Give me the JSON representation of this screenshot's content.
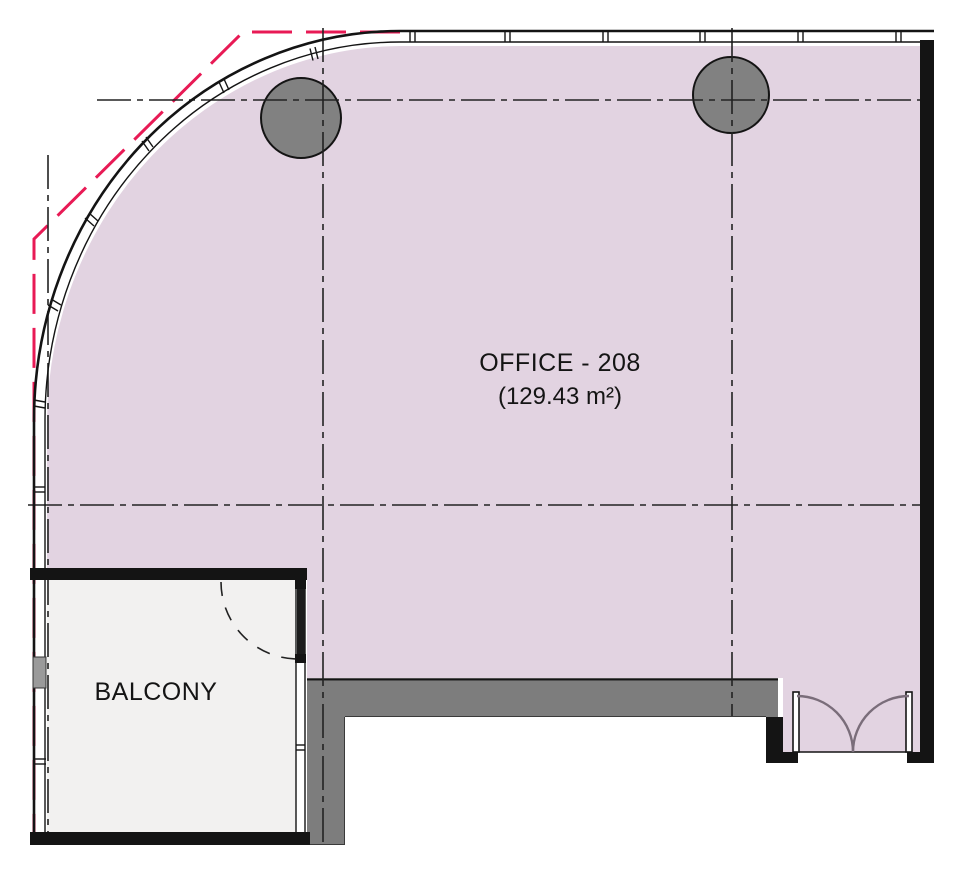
{
  "drawing": {
    "title": "Office 208 floor plan",
    "office": {
      "name": "OFFICE - 208",
      "area": "(129.43 m²)"
    },
    "balcony": {
      "name": "BALCONY"
    },
    "colors": {
      "room_fill": "#e2d3e1",
      "balcony_fill": "#f2f1f0",
      "column_fill": "#818181",
      "slab_fill": "#7d7d7d",
      "wall_dark": "#141414",
      "boundary_red": "#e81a55",
      "door_swing": "#7a6d7a",
      "mullion_block": "#9a9a9a"
    }
  }
}
